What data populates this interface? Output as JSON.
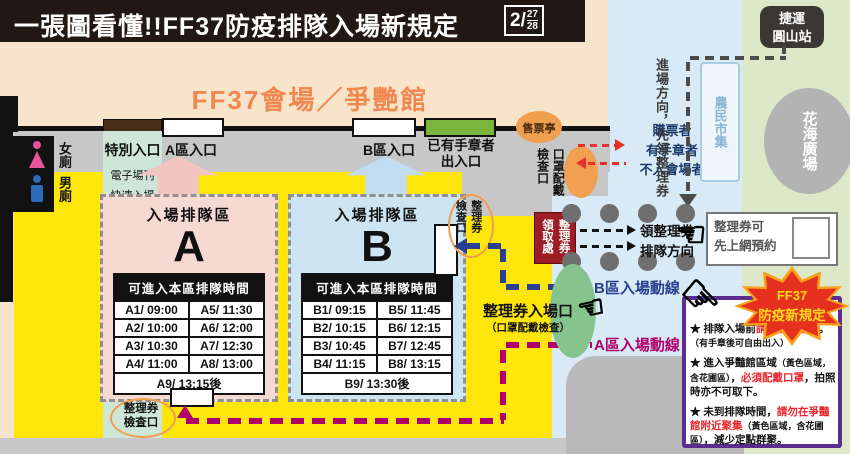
{
  "colors": {
    "title_bar": "#221712",
    "venue_bg": "#f8e3cb",
    "venue_title": "#f0894f",
    "sidewalk": "#c7c7c7",
    "plaza_yellow": "#ffe60a",
    "mint": "#cde6d8",
    "queue_a_pink": "#f7d9d4",
    "queue_b_blue": "#cde4f3",
    "street_blue": "#d8eaf5",
    "park_green": "#dce8c8",
    "office_red": "#9c1d23",
    "route_a": "#b0006b",
    "route_b": "#2a3f8f",
    "alert_red": "#e63329",
    "panel_purple": "#5b2d8e",
    "burst_red": "#e6311e",
    "burst_text": "#ffd919",
    "gate_green": "#7cb53e",
    "booth_orange": "#ef9f4e"
  },
  "header": {
    "title": "一張圖看懂!!FF37防疫排隊入場新規定",
    "date_month": "2/",
    "date_day1": "27",
    "date_day2": "28"
  },
  "venue": {
    "name": "FF37會場／爭艷館",
    "gates": {
      "a": "A區入口",
      "b": "B區入口",
      "stamped_line1": "已有手章者",
      "stamped_line2": "出入口",
      "ticket_booth": "售票亭"
    },
    "toilets": {
      "female": "女廁",
      "male": "男廁"
    }
  },
  "special_lane": {
    "title": "特別入口",
    "line1": "電子場刊",
    "line2": "快速入場",
    "line3": "VIP入場",
    "line4": "排隊處",
    "dir_left": "排隊方向",
    "dir_right": "特別入場"
  },
  "queue_a": {
    "title": "入場排隊區",
    "letter": "A",
    "table_header": "可進入本區排隊時間",
    "rows": [
      [
        "A1/ 09:00",
        "A5/ 11:30"
      ],
      [
        "A2/ 10:00",
        "A6/ 12:00"
      ],
      [
        "A3/ 10:30",
        "A7/ 12:30"
      ],
      [
        "A4/ 11:00",
        "A8/ 13:00"
      ]
    ],
    "last_row": "A9/ 13:15後"
  },
  "queue_b": {
    "title": "入場排隊區",
    "letter": "B",
    "table_header": "可進入本區排隊時間",
    "rows": [
      [
        "B1/ 09:15",
        "B5/ 11:45"
      ],
      [
        "B2/ 10:15",
        "B6/ 12:15"
      ],
      [
        "B3/ 10:45",
        "B7/ 12:45"
      ],
      [
        "B4/ 11:15",
        "B8/ 13:15"
      ]
    ],
    "last_row": "B9/ 13:30後"
  },
  "checks": {
    "mask_col1": "口罩配戴",
    "mask_col2": "檢查口",
    "side_check": "整理券檢查口",
    "bottom_check_line1": "整理券",
    "bottom_check_line2": "檢查口"
  },
  "flows": {
    "buyer1": "購票者",
    "buyer2": "有手章者",
    "buyer3": "不入會場者",
    "ticket_office": "整理券領取處",
    "get1": "領整理券",
    "get2": "排隊方向",
    "approach": "進場方向，先領整理券",
    "b_route": "B區入場動線",
    "a_route": "A區入場動線",
    "entrance": "整理券入場口",
    "entrance_sub": "（口罩配戴檢查）"
  },
  "landmarks": {
    "mrt1": "捷運",
    "mrt2": "圓山站",
    "market": "農民市集",
    "plaza": "花海廣場"
  },
  "reserve": {
    "line1": "整理券可",
    "line2": "先上網預約"
  },
  "burst": {
    "line1": "FF37",
    "line2": "防疫新規定"
  },
  "rules": {
    "items": [
      [
        {
          "t": "★ 排隊入場前"
        },
        {
          "t": "請先領整理券",
          "red": true
        },
        {
          "t": "。"
        },
        {
          "t": "（有手章後可自由出入）",
          "small": true,
          "br": true
        }
      ],
      [
        {
          "t": "★ 進入爭豔館區域"
        },
        {
          "t": "（黃色區域，含花圃區）",
          "small": true
        },
        {
          "t": "，"
        },
        {
          "t": "必須配戴口罩",
          "red": true
        },
        {
          "t": "，拍照時亦不可取下。"
        }
      ],
      [
        {
          "t": "★ 未到排隊時間，"
        },
        {
          "t": "請勿在爭豔館附近聚集",
          "red": true
        },
        {
          "t": "（黃色區域，含花圃區）",
          "small": true
        },
        {
          "t": "，減少定點群聚。"
        }
      ]
    ]
  }
}
